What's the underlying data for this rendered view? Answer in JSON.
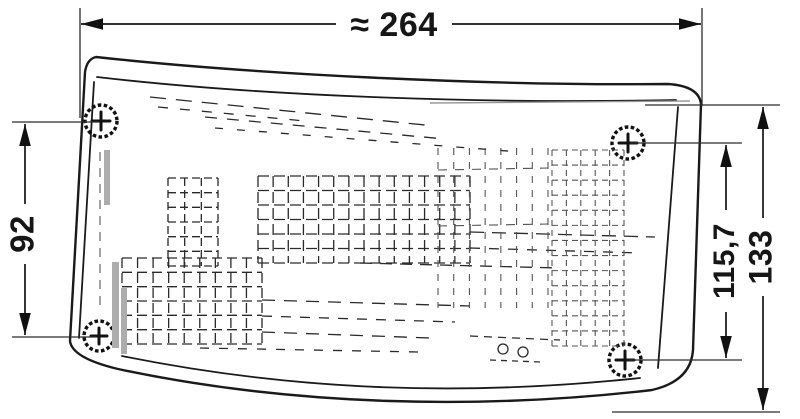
{
  "drawing": {
    "type": "technical-dimension-drawing",
    "subject": "lamp housing with lens texture, four fixing screws and dimension lines",
    "dimensions": {
      "width": "≈ 264",
      "left_height": "92",
      "right_inner_height": "115,7",
      "right_outer_height": "133"
    },
    "colors": {
      "line": "#1a1a1a",
      "background": "#ffffff"
    }
  }
}
